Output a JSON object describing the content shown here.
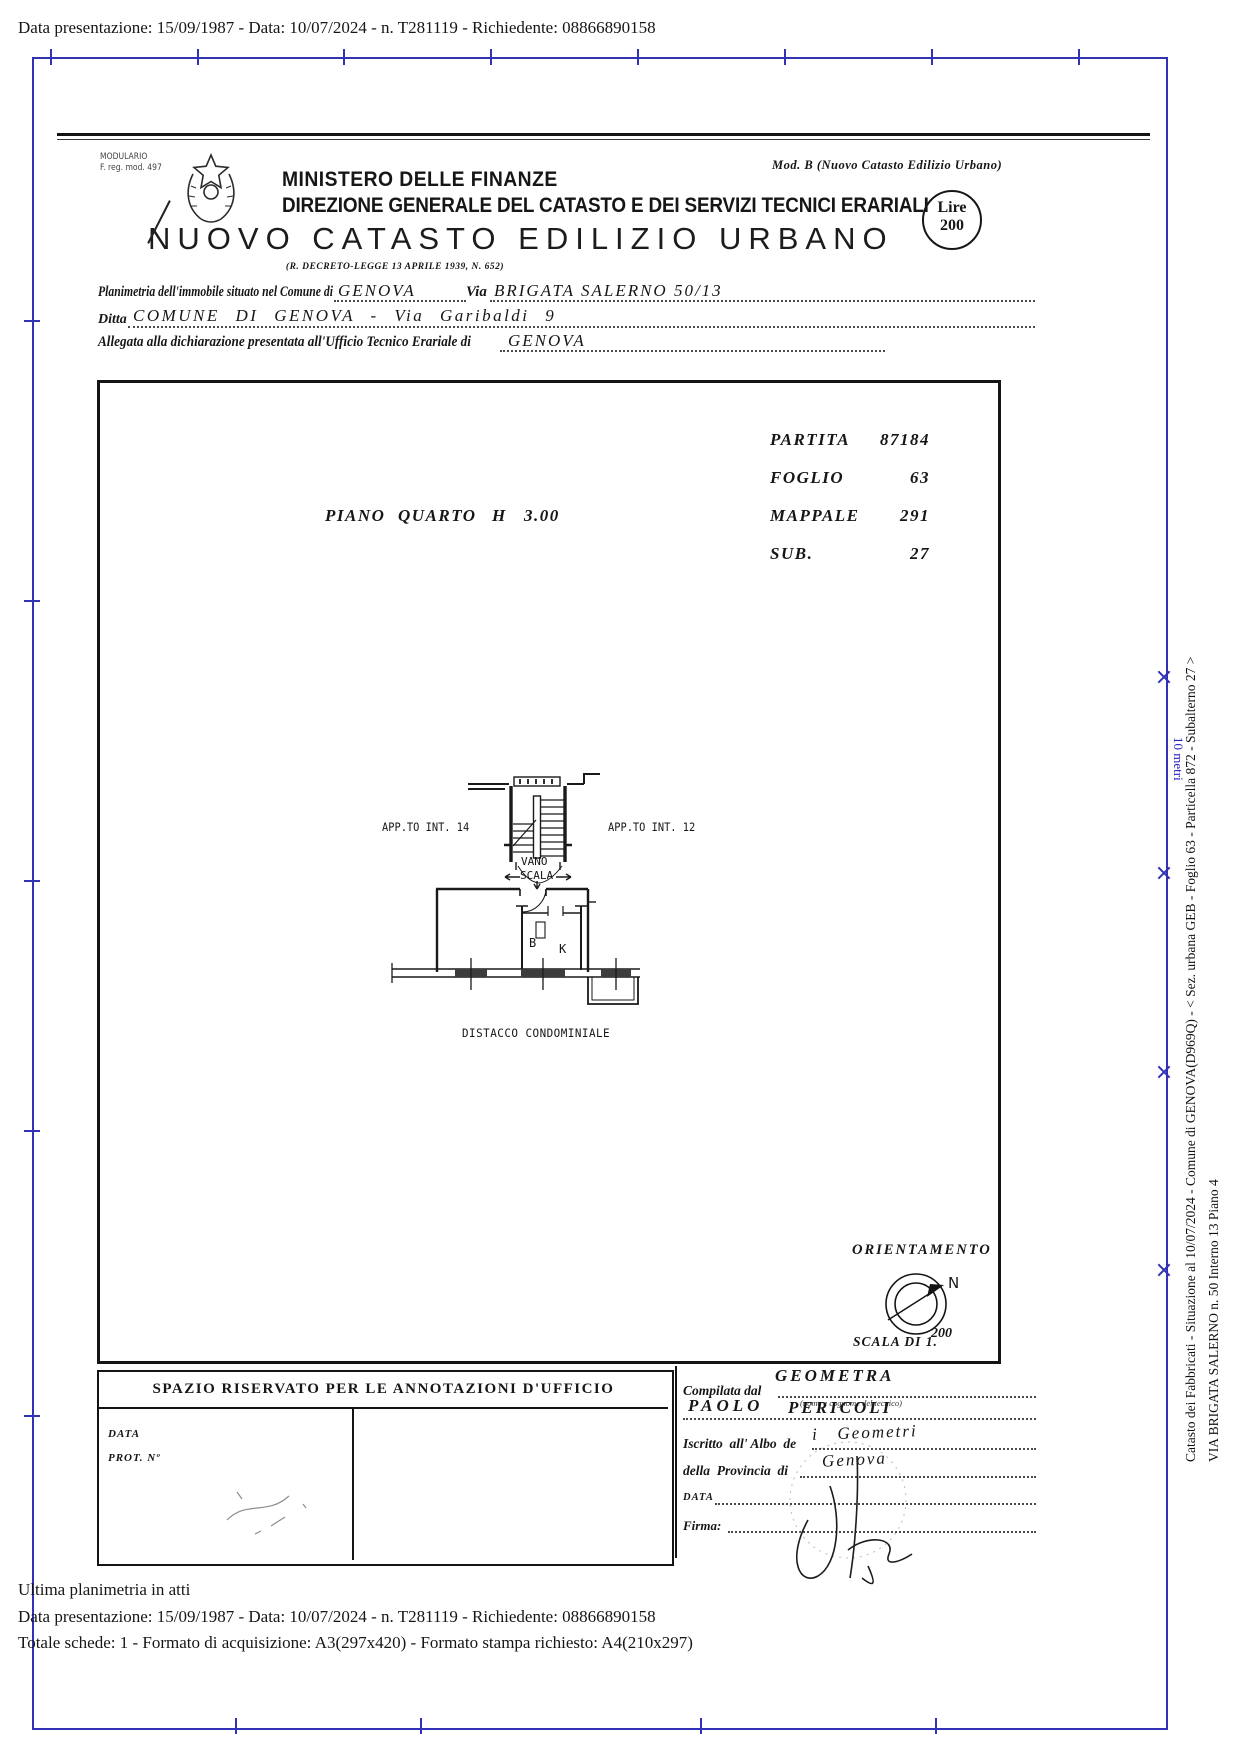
{
  "top_bar": {
    "text": "Data presentazione: 15/09/1987 - Data: 10/07/2024 - n. T281119 - Richiedente: 08866890158"
  },
  "header": {
    "modulario_line1": "MODULARIO",
    "modulario_line2": "F. reg. mod. 497",
    "ministry": "MINISTERO DELLE FINANZE",
    "direction": "DIREZIONE GENERALE DEL CATASTO E DEI SERVIZI TECNICI ERARIALI",
    "mod_b": "Mod. B (Nuovo Catasto Edilizio Urbano)",
    "lire_label": "Lire",
    "lire_value": "200",
    "title": "NUOVO CATASTO EDILIZIO URBANO",
    "subtitle": "(R. DECRETO-LEGGE 13 APRILE 1939, N. 652)"
  },
  "form": {
    "line1_label": "Planimetria dell'immobile situato nel Comune di",
    "line1_value": "GENOVA",
    "via_label": "Via",
    "via_value": "BRIGATA SALERNO 50/13",
    "line2_label": "Ditta",
    "line2_value": "COMUNE DI GENOVA - Via Garibaldi 9",
    "line3_label": "Allegata alla dichiarazione presentata all'Ufficio Tecnico Erariale di",
    "line3_value": "GENOVA"
  },
  "plan": {
    "fields": [
      {
        "label": "PARTITA",
        "value": "87184"
      },
      {
        "label": "FOGLIO",
        "value": "63"
      },
      {
        "label": "MAPPALE",
        "value": "291"
      },
      {
        "label": "SUB.",
        "value": "27"
      }
    ],
    "piano_label": "PIANO",
    "piano_value": "QUARTO",
    "h_label": "H",
    "h_value": "3.00",
    "apt_left": "APP.TO INT. 14",
    "apt_right": "APP.TO INT. 12",
    "vano": "VANO",
    "scala": "SCALA",
    "room_b": "B",
    "room_k": "K",
    "distacco": "DISTACCO CONDOMINIALE",
    "orientamento": "ORIENTAMENTO",
    "north": "N",
    "scala_di": "SCALA DI 1.",
    "scala_value": "200"
  },
  "office_box": {
    "title": "SPAZIO RISERVATO PER LE ANNOTAZIONI D'UFFICIO",
    "data_label": "DATA",
    "prot_label": "PROT. Nº"
  },
  "compiler": {
    "compilata_label": "Compilata dal",
    "geometra": "GEOMETRA",
    "name_first": "PAOLO",
    "name_last": "PERICOLI",
    "tecnico_note": "(nome e cognome del tecnico)",
    "iscritto_label": "Iscritto  all' Albo  de",
    "iscritto_value": "i   Geometri",
    "provincia_label": "della  Provincia  di",
    "provincia_value": "Genova",
    "data_label": "DATA",
    "firma_label": "Firma:"
  },
  "sidebar": {
    "line1": "Catasto dei Fabbricati - Situazione al 10/07/2024 - Comune di GENOVA(D969Q) - < Sez. urbana GEB - Foglio 63 - Particella 872 - Subalterno 27 >",
    "line2": "VIA BRIGATA SALERNO n. 50  Interno 13  Piano 4",
    "ruler_label": "10 metri"
  },
  "footer": {
    "line1": "Ultima planimetria in atti",
    "line2": "Data presentazione: 15/09/1987 - Data: 10/07/2024 - n. T281119 - Richiedente: 08866890158",
    "line3": "Totale schede: 1 - Formato di acquisizione: A3(297x420) - Formato stampa richiesto: A4(210x297)"
  },
  "colors": {
    "frame_blue": "#3232b6",
    "ink": "#161616"
  }
}
